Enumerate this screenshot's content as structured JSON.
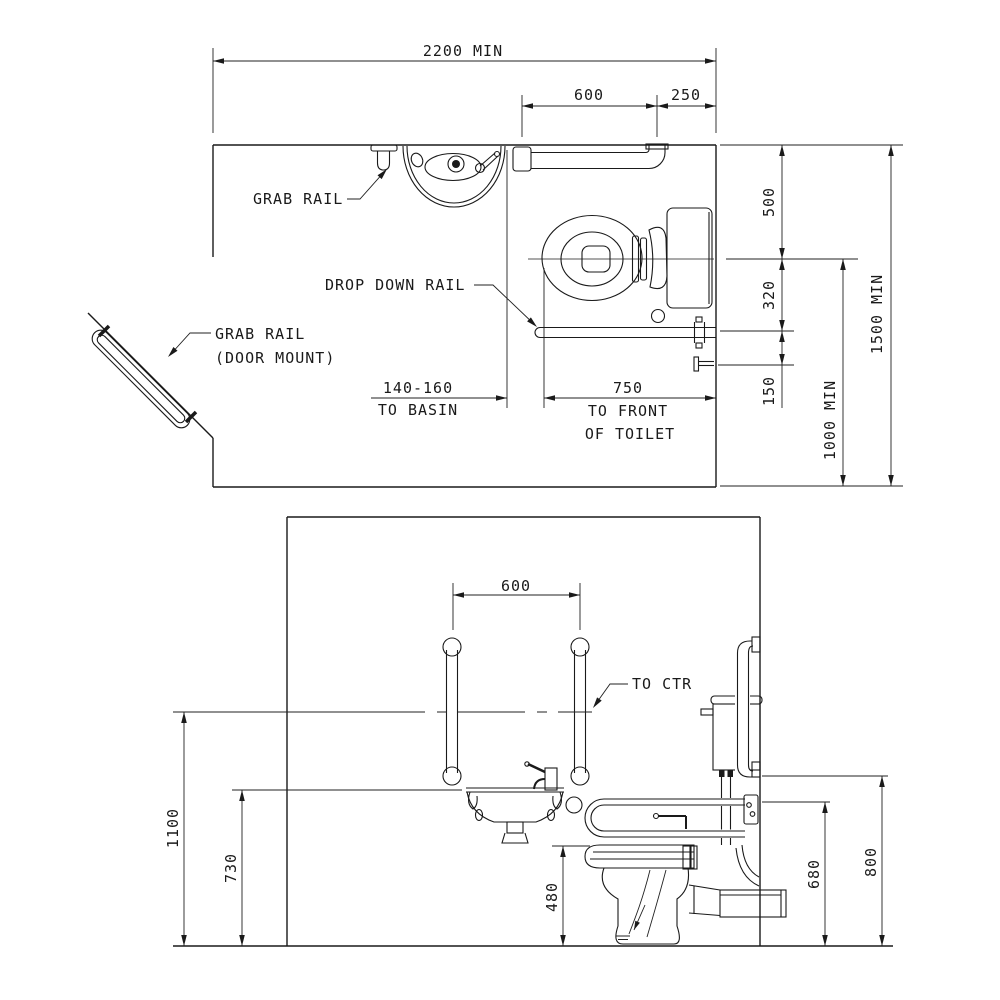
{
  "colors": {
    "line": "#1a1a1a",
    "dim": "#222222",
    "background": "#ffffff"
  },
  "plan_view": {
    "labels": {
      "grab_rail": "GRAB RAIL",
      "drop_down_rail": "DROP DOWN RAIL",
      "door_rail_line1": "GRAB RAIL",
      "door_rail_line2": "(DOOR MOUNT)"
    },
    "dimensions": {
      "overall_width": "2200 MIN",
      "rail_length": "600",
      "rail_to_wall": "250",
      "wall_to_centerline": "500",
      "centerline_to_rail": "320",
      "rail_to_holder": "150",
      "centerline_to_front": "1000 MIN",
      "room_depth": "1500 MIN",
      "basin_gap": "140-160",
      "basin_gap_caption": "TO BASIN",
      "toilet_front": "750",
      "toilet_front_caption1": "TO FRONT",
      "toilet_front_caption2": "OF TOILET"
    }
  },
  "elevation_view": {
    "labels": {
      "to_ctr": "TO CTR"
    },
    "dimensions": {
      "rail_spacing": "600",
      "rail_centre_height": "1100",
      "basin_height": "730",
      "seat_height": "480",
      "drop_rail_height": "680",
      "side_rail_height": "800"
    }
  }
}
